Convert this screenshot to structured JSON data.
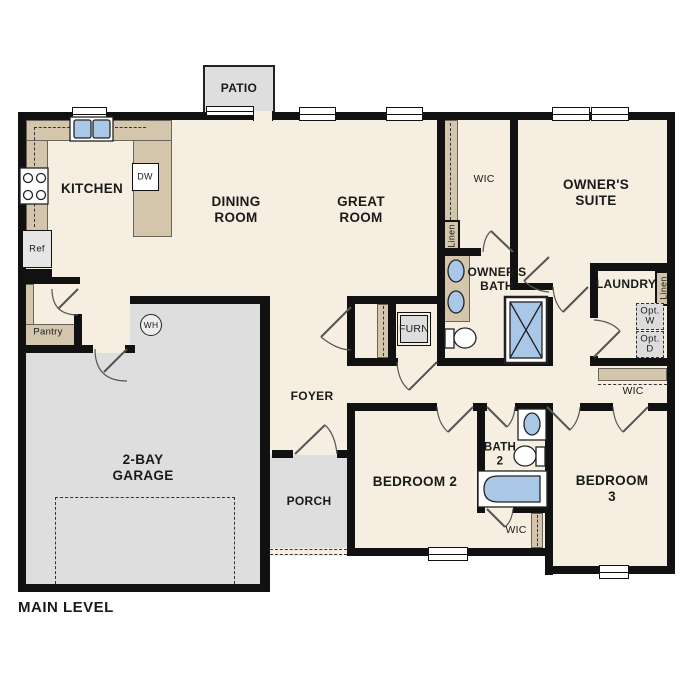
{
  "plan": {
    "title": "MAIN LEVEL",
    "colors": {
      "floor": "#f5eee1",
      "wall": "#111111",
      "casework_tan": "#d3c6ac",
      "exterior_gray": "#dedede",
      "fixture_blue": "#a9c8e8"
    },
    "rooms": {
      "kitchen": "KITCHEN",
      "dining_room": "DINING\nROOM",
      "great_room": "GREAT\nROOM",
      "owners_suite": "OWNER'S\nSUITE",
      "owners_wic": "WIC",
      "owners_bath": "OWNER'S\nBATH",
      "laundry": "LAUNDRY",
      "foyer": "FOYER",
      "porch": "PORCH",
      "patio": "PATIO",
      "garage": "2-BAY\nGARAGE",
      "bedroom2": "BEDROOM 2",
      "bedroom3": "BEDROOM 3",
      "bath2": "BATH\n2",
      "bedroom3_wic": "WIC",
      "hall_wic": "WIC"
    },
    "fixtures": {
      "ref": "Ref",
      "pantry": "Pantry",
      "dishwasher": "DW",
      "water_heater": "WH",
      "furnace": "FURN",
      "linen_wic": "Linen",
      "linen_laundry": "Linen",
      "opt_washer": "Opt.\nW",
      "opt_dryer": "Opt.\nD"
    }
  }
}
